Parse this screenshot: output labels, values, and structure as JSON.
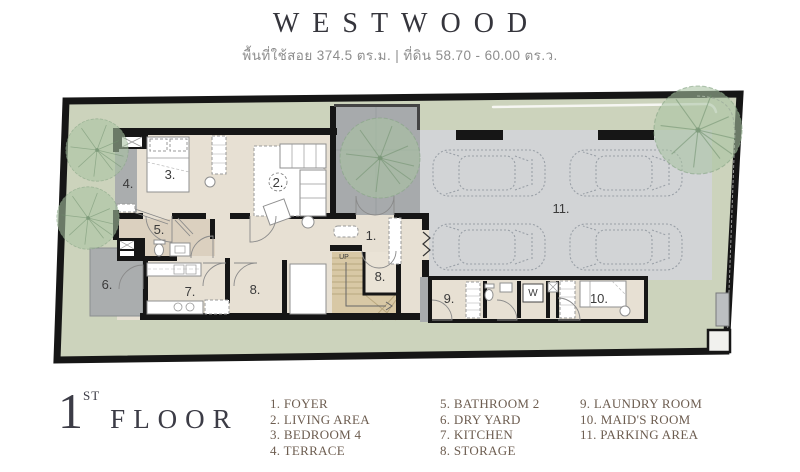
{
  "header": {
    "title": "WESTWOOD",
    "subtitle": "พื้นที่ใช้สอย 374.5 ตร.ม. | ที่ดิน 58.70 - 60.00 ตร.ว."
  },
  "floor_label": {
    "number": "1",
    "ordinal": "ST",
    "word": "FLOOR"
  },
  "legend": {
    "items": [
      {
        "label": "1. FOYER"
      },
      {
        "label": "2. LIVING AREA"
      },
      {
        "label": "3. BEDROOM 4"
      },
      {
        "label": "4. TERRACE"
      },
      {
        "label": "5. BATHROOM 2"
      },
      {
        "label": "6. DRY YARD"
      },
      {
        "label": "7. KITCHEN"
      },
      {
        "label": "8. STORAGE"
      },
      {
        "label": "9. LAUNDRY ROOM"
      },
      {
        "label": "10. MAID'S ROOM"
      },
      {
        "label": "11. PARKING AREA"
      }
    ]
  },
  "plan": {
    "labels": {
      "foyer": "1.",
      "living": "2.",
      "bedroom4": "3.",
      "terrace": "4.",
      "bathroom2": "5.",
      "dry_yard": "6.",
      "kitchen": "7.",
      "storage_hall": "8.",
      "storage_stair": "8.",
      "laundry": "9.",
      "maid": "10.",
      "parking": "11.",
      "stairs_up": "UP",
      "washer": "W"
    },
    "colors": {
      "lot_green": "#ccd3bc",
      "floor_beige": "#e7e0d3",
      "bath_tint": "#dbd0bf",
      "parking_gray": "#d2d4d6",
      "court_gray": "#a7aaac",
      "terrace_gray": "#aaadae",
      "stair_tan": "#d8c8a5",
      "wall_black": "#161616",
      "tree_green": "#a9c3a2",
      "legend_brown": "#6d5d50",
      "title_dark": "#35353c"
    }
  }
}
